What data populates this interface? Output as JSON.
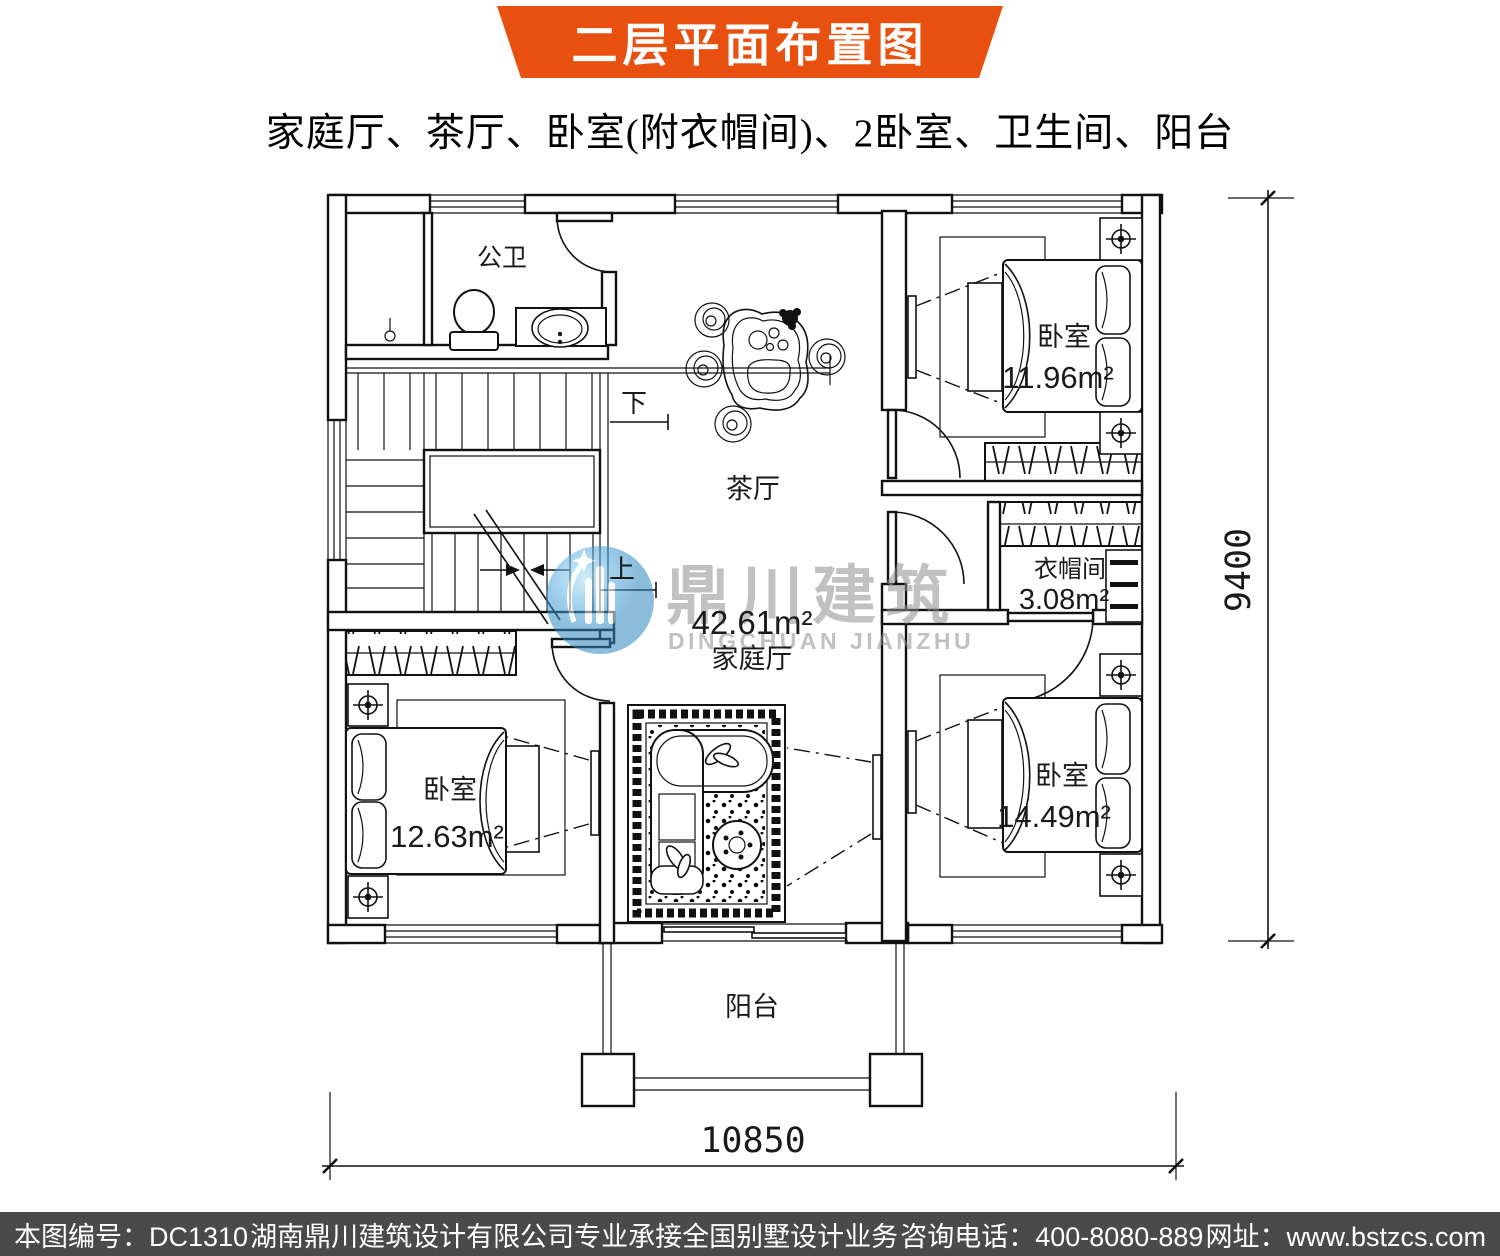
{
  "banner": {
    "title": "二层平面布置图"
  },
  "subtitle": "家庭厅、茶厅、卧室(附衣帽间)、2卧室、卫生间、阳台",
  "plan": {
    "rooms": {
      "bathroom": {
        "label": "公卫"
      },
      "tea_hall": {
        "label": "茶厅"
      },
      "bedroom_top_right": {
        "label": "卧室",
        "area": "11.96m²"
      },
      "cloakroom": {
        "label": "衣帽间",
        "area": "3.08m²"
      },
      "family_hall": {
        "label": "家庭厅",
        "area": "42.61m²"
      },
      "bedroom_bottom_left": {
        "label": "卧室",
        "area": "12.63m²"
      },
      "bedroom_bottom_right": {
        "label": "卧室",
        "area": "14.49m²"
      },
      "balcony": {
        "label": "阳台"
      }
    },
    "stairs": {
      "down": "下",
      "up": "上"
    },
    "dimensions": {
      "bottom": "10850",
      "right": "9400"
    }
  },
  "watermark": {
    "name_cn": "鼎川建筑",
    "name_en": "DINGCHUAN JIANZHU"
  },
  "footer": {
    "sheet_no": "本图编号：DC1310",
    "company": "湖南鼎川建筑设计有限公司专业承接全国别墅设计业务",
    "phone": "咨询电话：400-8080-889",
    "website": "网址：www.bstzcs.com"
  },
  "colors": {
    "banner_orange": "#E8500F",
    "footer_gray": "#4A4A4A",
    "watermark_blue": "#4DA6DC",
    "line": "#111111"
  }
}
